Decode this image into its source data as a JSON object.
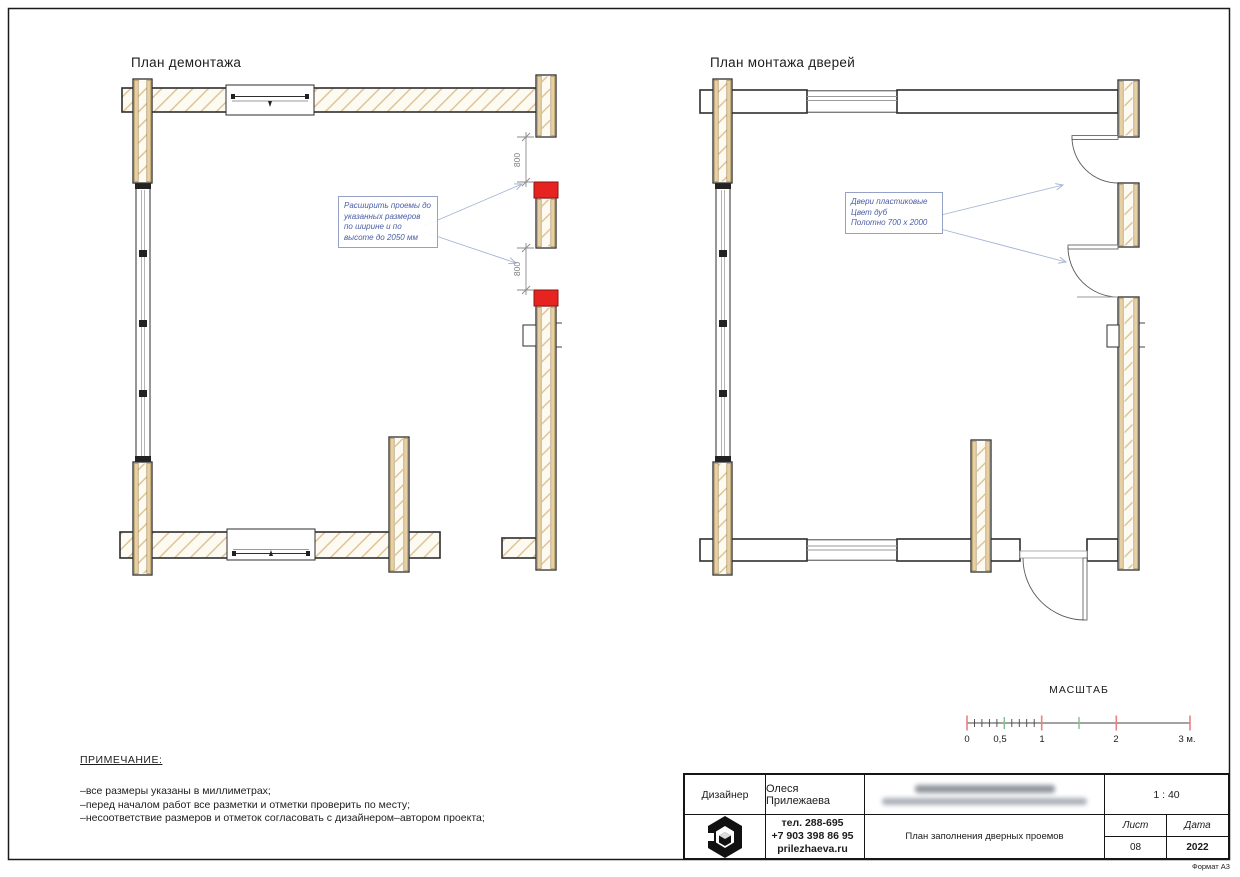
{
  "page": {
    "format_label": "Формат А3"
  },
  "colors": {
    "demolition_marker": "#e62320",
    "wall_wood": "#e6d0a4",
    "annotation_blue": "#4a5da8",
    "scale_major_tick": "#ea8080",
    "scale_half_tick": "#86bd90"
  },
  "plans": {
    "demolition": {
      "title": "План демонтажа",
      "annotation": {
        "lines": [
          "Расширить проемы до",
          "указанных размеров",
          "по ширине и по",
          "высоте до 2050 мм"
        ]
      },
      "dimensions": [
        "800",
        "800"
      ]
    },
    "installation": {
      "title": "План монтажа дверей",
      "annotation": {
        "lines": [
          "Двери пластиковые",
          "Цвет дуб",
          "Полотно 700 x 2000"
        ]
      }
    }
  },
  "scale_bar": {
    "title": "МАСШТАБ",
    "labels": [
      "0",
      "0,5",
      "1",
      "2",
      "3 м."
    ]
  },
  "notes": {
    "heading": "ПРИМЕЧАНИЕ:",
    "items": [
      "–все размеры указаны в миллиметрах;",
      "–перед началом работ все разметки и отметки проверить по месту;",
      "–несоответствие размеров и отметок согласовать с дизайнером–автором проекта;"
    ]
  },
  "title_block": {
    "designer_label": "Дизайнер",
    "designer_name": "Олеся Прилежаева",
    "scale_value": "1 : 40",
    "contacts": [
      "тел. 288-695",
      "+7 903 398 86 95",
      "prilezhaeva.ru"
    ],
    "drawing_title": "План заполнения дверных проемов",
    "sheet_label": "Лист",
    "sheet_value": "08",
    "date_label": "Дата",
    "date_value": "2022"
  }
}
